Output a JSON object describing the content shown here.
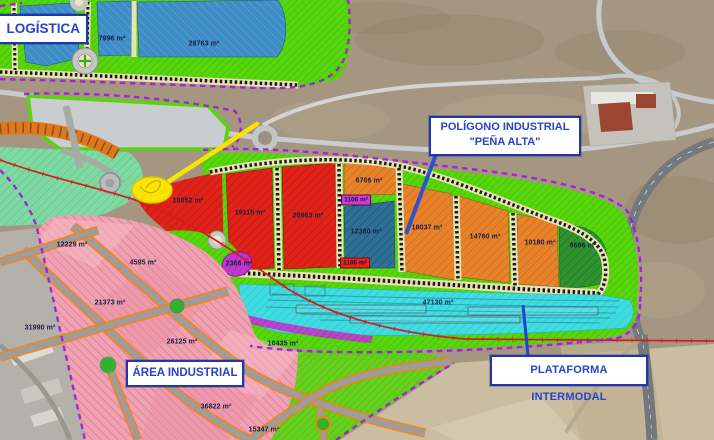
{
  "title": "Site plan – Polígono Industrial Peña Alta",
  "callouts": {
    "logistica": {
      "label": "LOGÍSTICA"
    },
    "poligono": {
      "line1": "POLÍGONO INDUSTRIAL",
      "line2": "\"PEÑA ALTA\""
    },
    "area_industrial": {
      "label": "ÁREA INDUSTRIAL"
    },
    "plataforma": {
      "label": "PLATAFORMA INTERMODAL"
    }
  },
  "zones": {
    "logistica": {
      "name": "LOGÍSTICA",
      "fill_color": "#3e8dc6",
      "parcels": [
        {
          "area": "14045 m²"
        },
        {
          "area": "7996 m²"
        },
        {
          "area": "28763 m²"
        }
      ]
    },
    "pena_alta": {
      "name": "POLÍGONO INDUSTRIAL \"PEÑA ALTA\"",
      "parcels": [
        {
          "area": "10052 m²",
          "color": "#e02318"
        },
        {
          "area": "19115 m²",
          "color": "#e02318"
        },
        {
          "area": "20963 m²",
          "color": "#e02318"
        },
        {
          "area": "6706 m²",
          "color": "#e8832b"
        },
        {
          "area": "1106 m²",
          "color": "#cf3ccf"
        },
        {
          "area": "12380 m²",
          "color": "#2e7096"
        },
        {
          "area": "1106 m²",
          "color": "#ee2020"
        },
        {
          "area": "18037 m²",
          "color": "#e8832b"
        },
        {
          "area": "14760 m²",
          "color": "#e8832b"
        },
        {
          "area": "10180 m²",
          "color": "#e8832b"
        },
        {
          "area": "9696 m²",
          "color": "#2f9330"
        },
        {
          "area": "2366 m²",
          "color": "#c238cc"
        }
      ]
    },
    "plataforma": {
      "name": "PLATAFORMA INTERMODAL",
      "fill_color": "#41dbe2",
      "parcels": [
        {
          "area": "47130 m²"
        }
      ]
    },
    "area_industrial": {
      "name": "ÁREA INDUSTRIAL",
      "fill_color": "#efa2b1",
      "parcels": [
        {
          "area": "12229 m²"
        },
        {
          "area": "4595 m²"
        },
        {
          "area": "21373 m²"
        },
        {
          "area": "31990 m²"
        },
        {
          "area": "26125 m²"
        },
        {
          "area": "10435 m²"
        },
        {
          "area": "36822 m²"
        },
        {
          "area": "15347 m²"
        }
      ]
    }
  },
  "colors": {
    "callout_border": "#2136b4",
    "callout_text": "#2743c8",
    "boundary_dashed": "#a21fd6",
    "green_strip": "#57d60c",
    "railway_red": "#cf1f1f",
    "highlight_yellow": "#fbe400",
    "road_edge_orange": "#ef8318"
  }
}
